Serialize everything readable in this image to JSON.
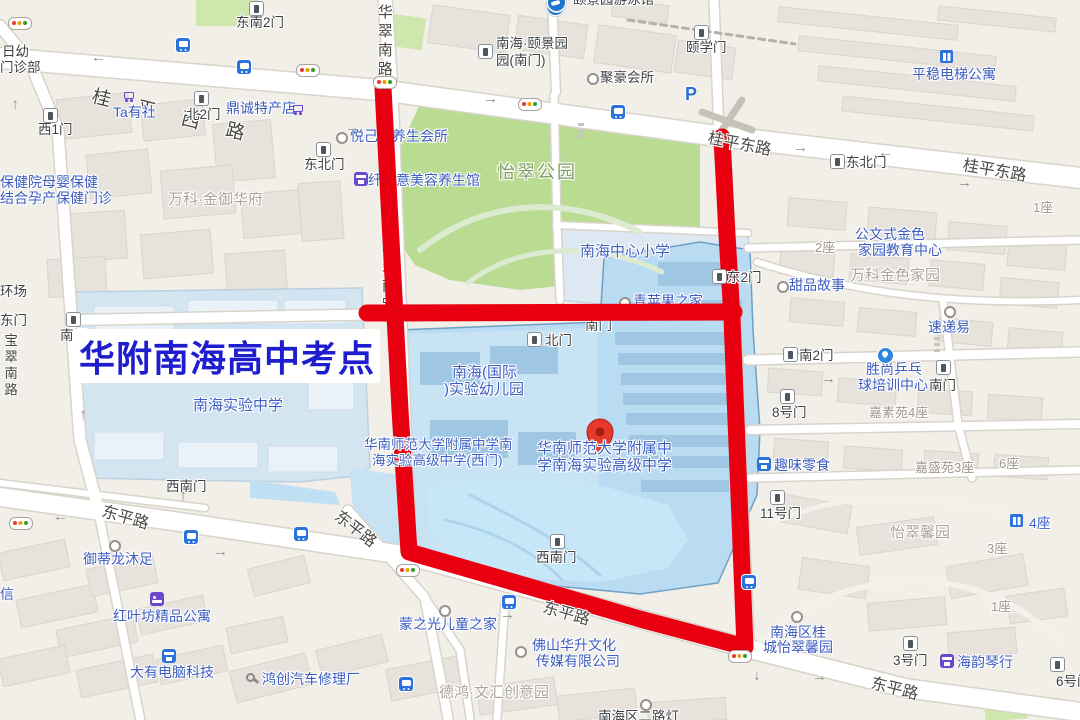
{
  "title": {
    "text": "华附南海高中考点",
    "color": "#1e1ecf"
  },
  "colors": {
    "route_red": "#e80011",
    "map_bg": "#f2efe8",
    "park_green": "#b9dc92",
    "campus_blue": "#badcf2",
    "poi_blue": "#3c5cc0",
    "road_gray": "#4a4a47"
  },
  "pin": {
    "x": 600,
    "y": 455,
    "fill": "#e6392b",
    "dot": "#a21f12",
    "label": "location-pin"
  },
  "route": {
    "color": "#e80011",
    "width": 17,
    "paths": [
      [
        [
          383,
          88
        ],
        [
          391,
          240
        ],
        [
          400,
          410
        ],
        [
          409,
          552
        ],
        [
          520,
          584
        ],
        [
          640,
          619
        ],
        [
          745,
          647
        ],
        [
          740,
          520
        ],
        [
          735,
          395
        ],
        [
          732,
          318
        ],
        [
          727,
          235
        ],
        [
          722,
          137
        ]
      ],
      [
        [
          367,
          313
        ],
        [
          734,
          312
        ]
      ]
    ]
  },
  "labels": [
    {
      "t": "日幼",
      "x": 2,
      "y": 44,
      "c": "gate"
    },
    {
      "t": "门诊部",
      "x": 0,
      "y": 60,
      "c": "gate"
    },
    {
      "t": "桂平西路",
      "x": 92,
      "y": 86,
      "c": "roadsp",
      "r": 14
    },
    {
      "t": "东南2门",
      "x": 236,
      "y": 15,
      "c": "gate"
    },
    {
      "t": "Ta有社",
      "x": 113,
      "y": 105,
      "c": "poi"
    },
    {
      "t": "北2门",
      "x": 186,
      "y": 107,
      "c": "gate"
    },
    {
      "t": "鼎诚特产店",
      "x": 226,
      "y": 101,
      "c": "poi"
    },
    {
      "t": "西1门",
      "x": 38,
      "y": 122,
      "c": "gate"
    },
    {
      "t": "保健院母婴保健",
      "x": 0,
      "y": 175,
      "c": "poi"
    },
    {
      "t": "结合孕产保健门诊",
      "x": 0,
      "y": 191,
      "c": "poi"
    },
    {
      "t": "万科·金御华府",
      "x": 168,
      "y": 192,
      "c": "area"
    },
    {
      "t": "东北门",
      "x": 304,
      "y": 157,
      "c": "gate"
    },
    {
      "t": "华翠南路",
      "x": 375,
      "y": 4,
      "c": "roadv"
    },
    {
      "t": "华翠南路",
      "x": 379,
      "y": 240,
      "c": "roadv",
      "u": 1
    },
    {
      "t": "颐景园游泳馆",
      "x": 573,
      "y": -8,
      "c": "gate"
    },
    {
      "t": "南海·颐景园",
      "x": 496,
      "y": 36,
      "c": "gate"
    },
    {
      "t": "园(南门)",
      "x": 496,
      "y": 53,
      "c": "gate"
    },
    {
      "t": "聚豪会所",
      "x": 600,
      "y": 70,
      "c": "gate"
    },
    {
      "t": "颐学门",
      "x": 686,
      "y": 40,
      "c": "gate"
    },
    {
      "t": "平稳电梯公寓",
      "x": 912,
      "y": 67,
      "c": "poi"
    },
    {
      "t": "桂平东路",
      "x": 708,
      "y": 130,
      "c": "road",
      "r": 11
    },
    {
      "t": "桂平东路",
      "x": 963,
      "y": 157,
      "c": "road",
      "r": 10
    },
    {
      "t": "东北门",
      "x": 846,
      "y": 155,
      "c": "gate"
    },
    {
      "t": "1座",
      "x": 1033,
      "y": 201,
      "c": "areasm"
    },
    {
      "t": "公文式金色",
      "x": 855,
      "y": 227,
      "c": "poi"
    },
    {
      "t": "家园教育中心",
      "x": 858,
      "y": 243,
      "c": "poi"
    },
    {
      "t": "万科金色家园",
      "x": 850,
      "y": 268,
      "c": "area"
    },
    {
      "t": "2座",
      "x": 815,
      "y": 241,
      "c": "areasm"
    },
    {
      "t": "甜品故事",
      "x": 789,
      "y": 278,
      "c": "poi"
    },
    {
      "t": "东2门",
      "x": 727,
      "y": 270,
      "c": "gate"
    },
    {
      "t": "速递易",
      "x": 928,
      "y": 320,
      "c": "poi"
    },
    {
      "t": "怡翠公园",
      "x": 497,
      "y": 162,
      "c": "park"
    },
    {
      "t": "悦己颜养生会所",
      "x": 350,
      "y": 129,
      "c": "poi",
      "u": 1
    },
    {
      "t": "纤体意美容养生馆",
      "x": 368,
      "y": 173,
      "c": "poi",
      "u": 1
    },
    {
      "t": "南海中心小学",
      "x": 580,
      "y": 244,
      "c": "campus"
    },
    {
      "t": "青苹果之家",
      "x": 633,
      "y": 294,
      "c": "poi",
      "u": 1
    },
    {
      "t": "北门",
      "x": 545,
      "y": 333,
      "c": "gate"
    },
    {
      "t": "南门",
      "x": 60,
      "y": 328,
      "c": "gate"
    },
    {
      "t": "南门",
      "x": 585,
      "y": 318,
      "c": "gate",
      "u": 1
    },
    {
      "t": "东门",
      "x": 0,
      "y": 313,
      "c": "gate"
    },
    {
      "t": "环场",
      "x": 0,
      "y": 284,
      "c": "gate"
    },
    {
      "t": "宝翠南路",
      "x": 2,
      "y": 333,
      "c": "roadv2"
    },
    {
      "t": "南海(国际",
      "x": 452,
      "y": 365,
      "c": "campus"
    },
    {
      "t": ")实验幼儿园",
      "x": 444,
      "y": 382,
      "c": "campus"
    },
    {
      "t": "华南师范大学附属中学南",
      "x": 364,
      "y": 437,
      "c": "campus",
      "fs": 13.5
    },
    {
      "t": "海实验高级中学(西门)",
      "x": 372,
      "y": 453,
      "c": "campus",
      "fs": 13.5
    },
    {
      "t": "华南师范大学附属中",
      "x": 537,
      "y": 441,
      "c": "campus"
    },
    {
      "t": "学南海实验高级中学",
      "x": 537,
      "y": 458,
      "c": "campus"
    },
    {
      "t": "南海实验中学",
      "x": 193,
      "y": 398,
      "c": "campus"
    },
    {
      "t": "南2门",
      "x": 799,
      "y": 348,
      "c": "gate"
    },
    {
      "t": "胜尚乒乓",
      "x": 866,
      "y": 362,
      "c": "poi"
    },
    {
      "t": "球培训中心",
      "x": 858,
      "y": 378,
      "c": "poi"
    },
    {
      "t": "南门",
      "x": 929,
      "y": 378,
      "c": "gate"
    },
    {
      "t": "嘉素苑4座",
      "x": 869,
      "y": 406,
      "c": "areasm"
    },
    {
      "t": "8号门",
      "x": 772,
      "y": 405,
      "c": "gate"
    },
    {
      "t": "趣味零食",
      "x": 774,
      "y": 458,
      "c": "poi"
    },
    {
      "t": "嘉盛苑3座",
      "x": 915,
      "y": 461,
      "c": "areasm"
    },
    {
      "t": "6座",
      "x": 999,
      "y": 457,
      "c": "areasm"
    },
    {
      "t": "怡翠馨园",
      "x": 890,
      "y": 525,
      "c": "area"
    },
    {
      "t": "4座",
      "x": 1029,
      "y": 516,
      "c": "poi"
    },
    {
      "t": "3座",
      "x": 987,
      "y": 542,
      "c": "areasm"
    },
    {
      "t": "1座",
      "x": 991,
      "y": 600,
      "c": "areasm"
    },
    {
      "t": "11号门",
      "x": 760,
      "y": 506,
      "c": "gate"
    },
    {
      "t": "南海区桂",
      "x": 770,
      "y": 625,
      "c": "poi"
    },
    {
      "t": "城怡翠馨园",
      "x": 763,
      "y": 640,
      "c": "poi"
    },
    {
      "t": "3号门",
      "x": 893,
      "y": 653,
      "c": "gate"
    },
    {
      "t": "海韵琴行",
      "x": 957,
      "y": 655,
      "c": "poi"
    },
    {
      "t": "6号门",
      "x": 1056,
      "y": 674,
      "c": "gate"
    },
    {
      "t": "东平路",
      "x": 871,
      "y": 675,
      "c": "road",
      "r": 14
    },
    {
      "t": "南海区二路灯",
      "x": 598,
      "y": 709,
      "c": "gate"
    },
    {
      "t": "东平路",
      "x": 102,
      "y": 503,
      "c": "road",
      "r": 16
    },
    {
      "t": "东平路",
      "x": 543,
      "y": 599,
      "c": "road",
      "r": 16
    },
    {
      "t": "东平路",
      "x": 336,
      "y": 506,
      "c": "road",
      "r": 38,
      "u": 1
    },
    {
      "t": "西南门",
      "x": 166,
      "y": 479,
      "c": "gate"
    },
    {
      "t": "西南门",
      "x": 536,
      "y": 550,
      "c": "gate"
    },
    {
      "t": "御蒂龙沐足",
      "x": 83,
      "y": 552,
      "c": "poi"
    },
    {
      "t": "红叶坊精品公寓",
      "x": 113,
      "y": 609,
      "c": "poi"
    },
    {
      "t": "大有电脑科技",
      "x": 130,
      "y": 665,
      "c": "poi"
    },
    {
      "t": "鸿创汽车修理厂",
      "x": 262,
      "y": 672,
      "c": "poi"
    },
    {
      "t": "信",
      "x": 0,
      "y": 587,
      "c": "poi"
    },
    {
      "t": "蒙之光儿童之家",
      "x": 399,
      "y": 617,
      "c": "poi"
    },
    {
      "t": "佛山华升文化",
      "x": 532,
      "y": 638,
      "c": "poi"
    },
    {
      "t": "传媒有限公司",
      "x": 536,
      "y": 654,
      "c": "poi"
    },
    {
      "t": "德鸿·文汇创意园",
      "x": 439,
      "y": 685,
      "c": "area"
    },
    {
      "t": "→",
      "x": 345,
      "y": 120,
      "c": "arr"
    },
    {
      "t": "→",
      "x": 106,
      "y": 52,
      "c": "arr",
      "r": 180
    },
    {
      "t": "→",
      "x": 483,
      "y": 91,
      "c": "arr"
    },
    {
      "t": "→",
      "x": 793,
      "y": 140,
      "c": "arr"
    },
    {
      "t": "→",
      "x": 893,
      "y": 147,
      "c": "arr",
      "r": 180
    },
    {
      "t": "→",
      "x": 957,
      "y": 175,
      "c": "arr"
    },
    {
      "t": "→",
      "x": 68,
      "y": 511,
      "c": "arr",
      "r": 180
    },
    {
      "t": "→",
      "x": 213,
      "y": 544,
      "c": "arr"
    },
    {
      "t": "→",
      "x": 500,
      "y": 607,
      "c": "arr"
    },
    {
      "t": "→",
      "x": 812,
      "y": 669,
      "c": "arr"
    },
    {
      "t": "→",
      "x": 821,
      "y": 371,
      "c": "arr"
    },
    {
      "t": "→",
      "x": 182,
      "y": 495,
      "c": "arr",
      "r": -90
    },
    {
      "t": "→",
      "x": 82,
      "y": 414,
      "c": "arr",
      "r": -90
    },
    {
      "t": "→",
      "x": 758,
      "y": 660,
      "c": "arr",
      "r": 90
    },
    {
      "t": "→",
      "x": 14,
      "y": 104,
      "c": "arr",
      "r": -90
    }
  ],
  "icons": [
    {
      "k": "light",
      "x": 8,
      "y": 17
    },
    {
      "k": "light",
      "x": 296,
      "y": 64
    },
    {
      "k": "light",
      "x": 373,
      "y": 76
    },
    {
      "k": "light",
      "x": 518,
      "y": 98
    },
    {
      "k": "light",
      "x": 9,
      "y": 517
    },
    {
      "k": "light",
      "x": 396,
      "y": 564
    },
    {
      "k": "light",
      "x": 728,
      "y": 650
    },
    {
      "k": "bus",
      "x": 176,
      "y": 38
    },
    {
      "k": "bus",
      "x": 237,
      "y": 60
    },
    {
      "k": "bus",
      "x": 611,
      "y": 105
    },
    {
      "k": "bus",
      "x": 184,
      "y": 530
    },
    {
      "k": "bus",
      "x": 294,
      "y": 527
    },
    {
      "k": "bus",
      "x": 502,
      "y": 595
    },
    {
      "k": "bus",
      "x": 399,
      "y": 677
    },
    {
      "k": "bus",
      "x": 742,
      "y": 575
    },
    {
      "k": "gate",
      "x": 249,
      "y": 1
    },
    {
      "k": "gate",
      "x": 194,
      "y": 91
    },
    {
      "k": "gate",
      "x": 43,
      "y": 108
    },
    {
      "k": "gate",
      "x": 316,
      "y": 142
    },
    {
      "k": "gate",
      "x": 478,
      "y": 44
    },
    {
      "k": "gate",
      "x": 694,
      "y": 25
    },
    {
      "k": "gate",
      "x": 830,
      "y": 154
    },
    {
      "k": "gate",
      "x": 712,
      "y": 269
    },
    {
      "k": "gate",
      "x": 527,
      "y": 332
    },
    {
      "k": "gate",
      "x": 66,
      "y": 312
    },
    {
      "k": "gate",
      "x": 783,
      "y": 347
    },
    {
      "k": "gate",
      "x": 936,
      "y": 360
    },
    {
      "k": "gate",
      "x": 780,
      "y": 389
    },
    {
      "k": "gate",
      "x": 770,
      "y": 490
    },
    {
      "k": "gate",
      "x": 550,
      "y": 534
    },
    {
      "k": "gate",
      "x": 903,
      "y": 636
    },
    {
      "k": "gate",
      "x": 1050,
      "y": 657
    },
    {
      "k": "cart",
      "x": 122,
      "y": 89
    },
    {
      "k": "cart",
      "x": 291,
      "y": 102
    },
    {
      "k": "circle",
      "x": 587,
      "y": 73
    },
    {
      "k": "circle",
      "x": 777,
      "y": 281
    },
    {
      "k": "circle",
      "x": 944,
      "y": 306
    },
    {
      "k": "circle",
      "x": 336,
      "y": 132,
      "u": 1
    },
    {
      "k": "circle",
      "x": 619,
      "y": 297,
      "u": 1
    },
    {
      "k": "circle",
      "x": 109,
      "y": 540
    },
    {
      "k": "circle",
      "x": 439,
      "y": 605
    },
    {
      "k": "circle",
      "x": 515,
      "y": 646
    },
    {
      "k": "circle",
      "x": 791,
      "y": 611
    },
    {
      "k": "circle",
      "x": 640,
      "y": 699
    },
    {
      "k": "bed",
      "x": 150,
      "y": 592
    },
    {
      "k": "shopp",
      "x": 354,
      "y": 172,
      "u": 1
    },
    {
      "k": "shopp",
      "x": 940,
      "y": 654
    },
    {
      "k": "shopb",
      "x": 757,
      "y": 457
    },
    {
      "k": "shopb",
      "x": 162,
      "y": 649
    },
    {
      "k": "bldg",
      "x": 940,
      "y": 50
    },
    {
      "k": "bldg",
      "x": 1010,
      "y": 514
    },
    {
      "k": "wrench",
      "x": 246,
      "y": 673
    },
    {
      "k": "p",
      "x": 685,
      "y": 84
    },
    {
      "k": "metro",
      "x": 546,
      "y": -3
    },
    {
      "k": "swim",
      "x": 547,
      "y": -7
    },
    {
      "k": "pp",
      "x": 877,
      "y": 347
    }
  ]
}
